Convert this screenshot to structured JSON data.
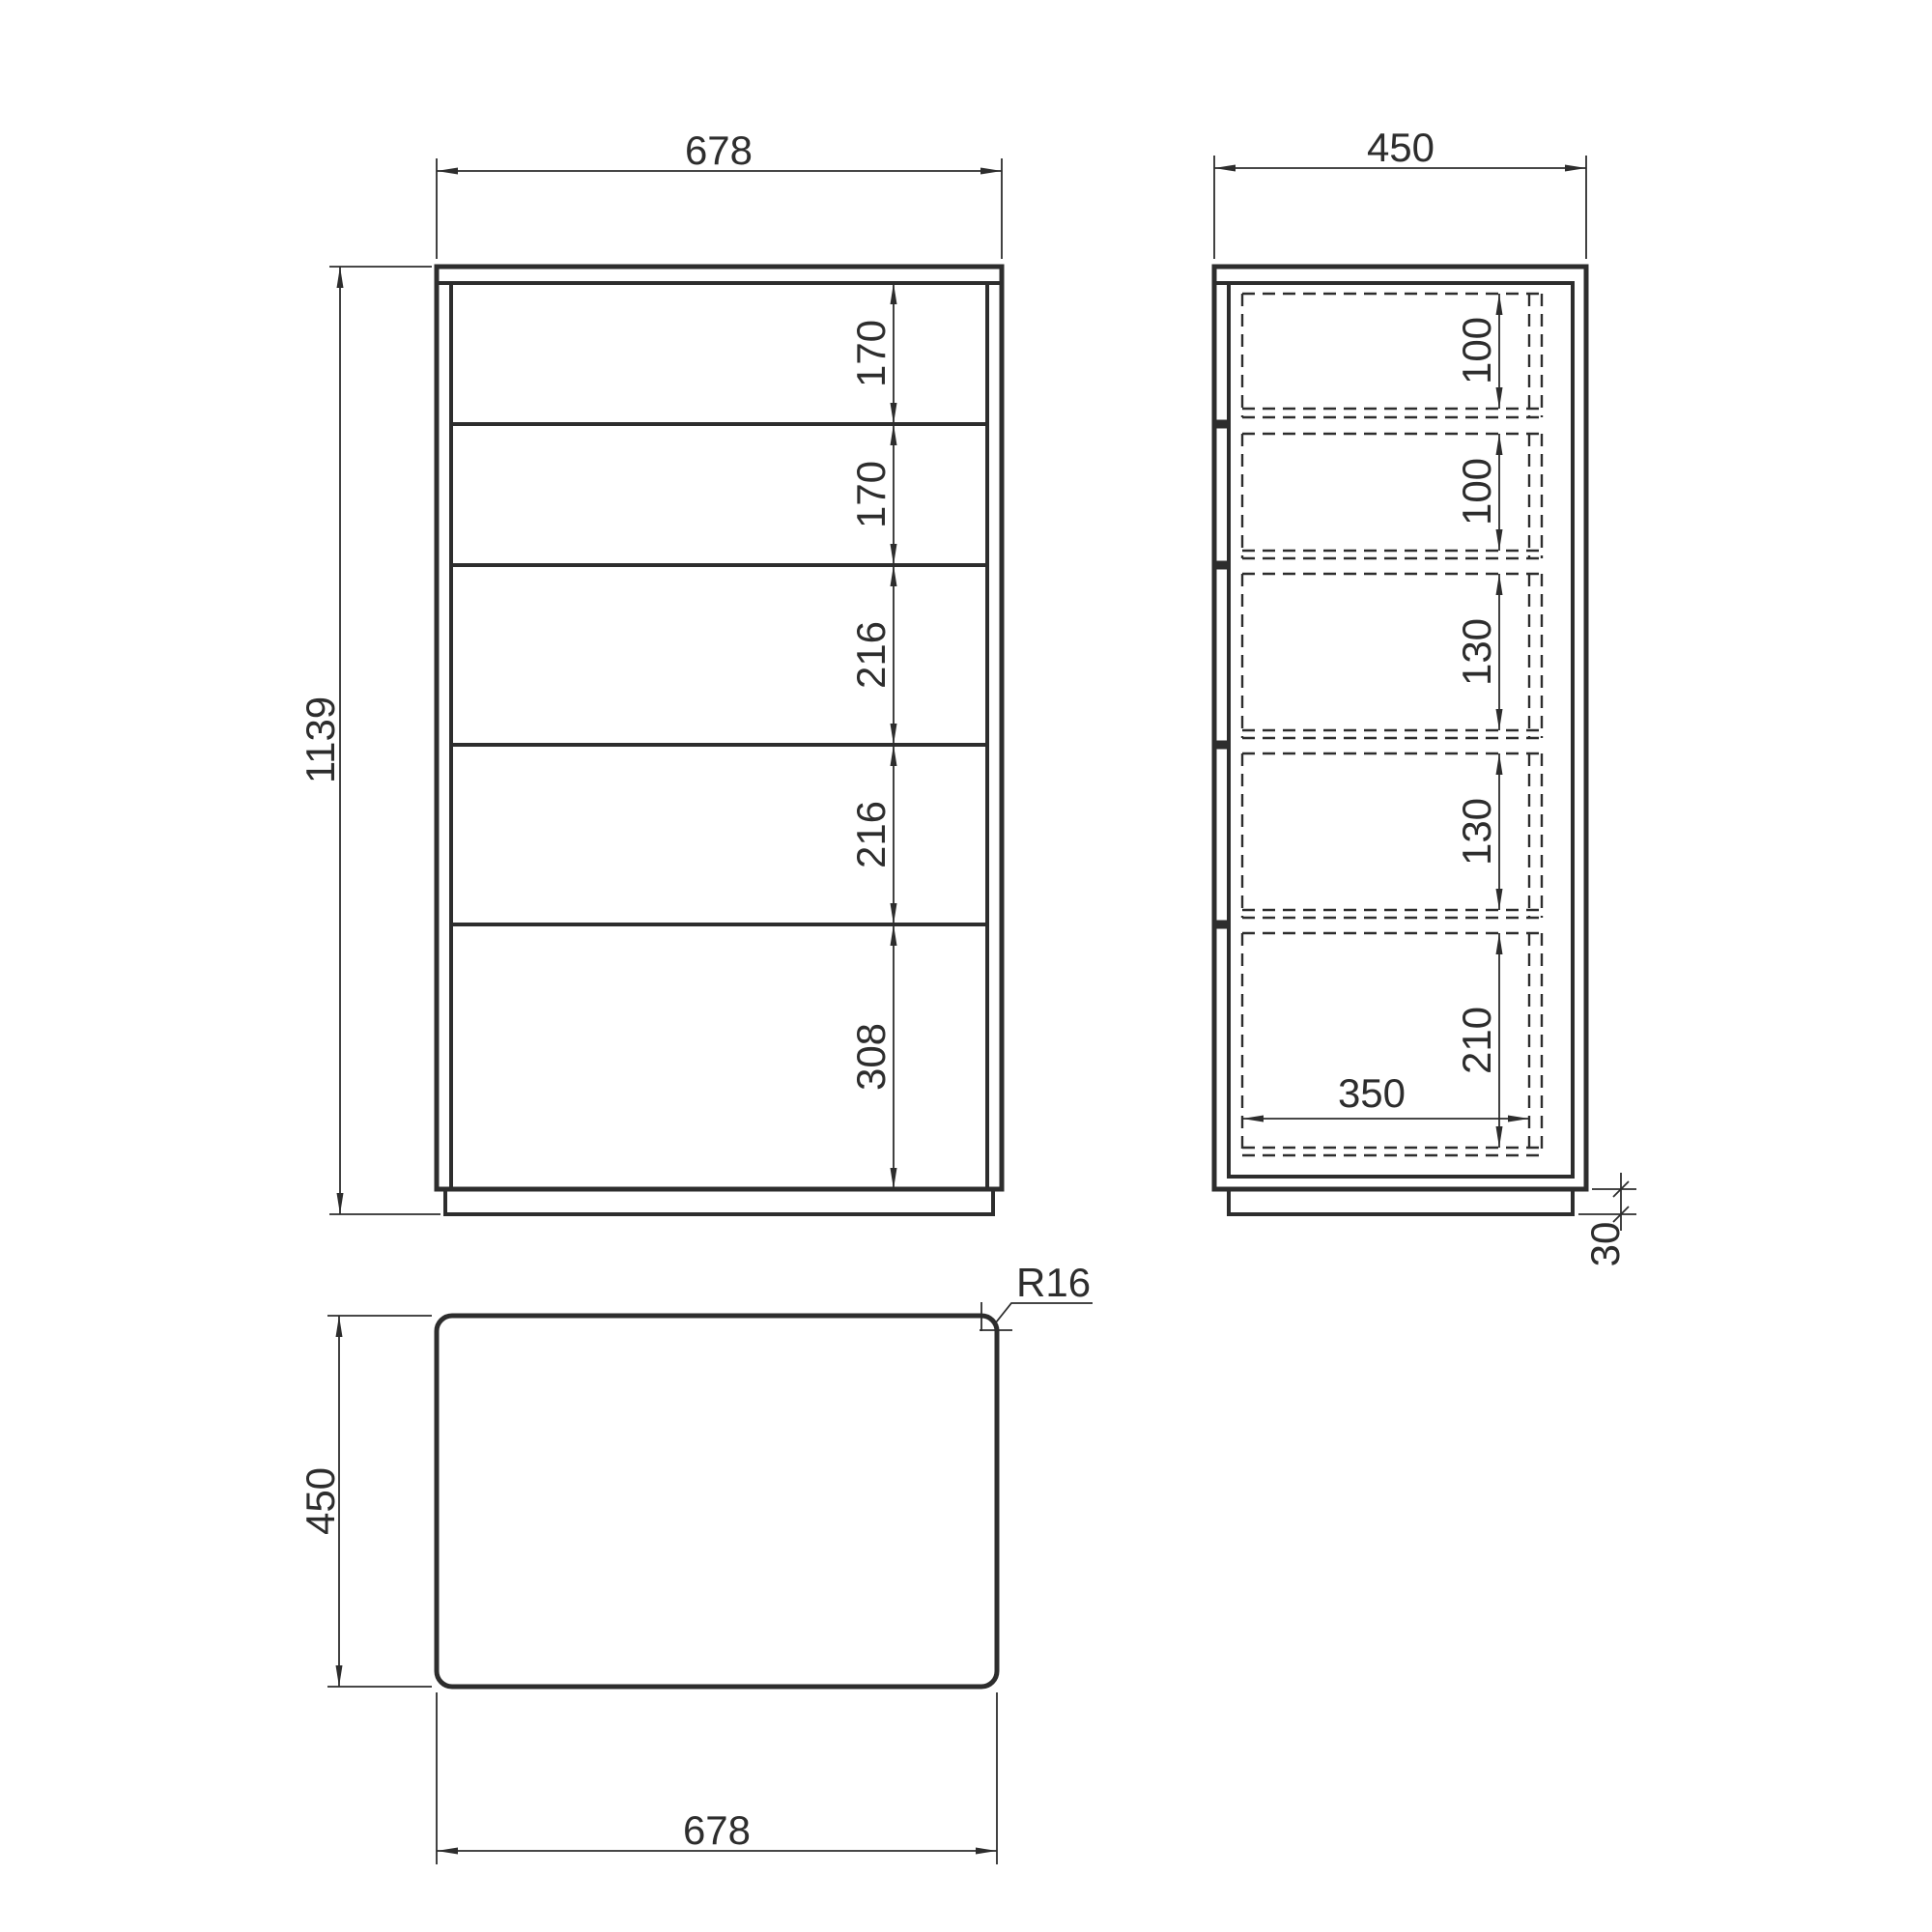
{
  "drawing": {
    "title": "chest-of-drawers-orthographic-views",
    "front_view": {
      "width_dim": "678",
      "height_dim": "1139",
      "drawer_dims": [
        "170",
        "170",
        "216",
        "216",
        "308"
      ]
    },
    "side_view": {
      "depth_dim": "450",
      "drawer_inner_dims": [
        "100",
        "100",
        "130",
        "130",
        "210"
      ],
      "drawer_depth_dim": "350",
      "plinth_dim": "30"
    },
    "top_view": {
      "depth_dim": "450",
      "width_dim": "678",
      "corner_radius_dim": "R16"
    },
    "colors": {
      "line": "#2d2d2d",
      "background": "#ffffff"
    }
  }
}
